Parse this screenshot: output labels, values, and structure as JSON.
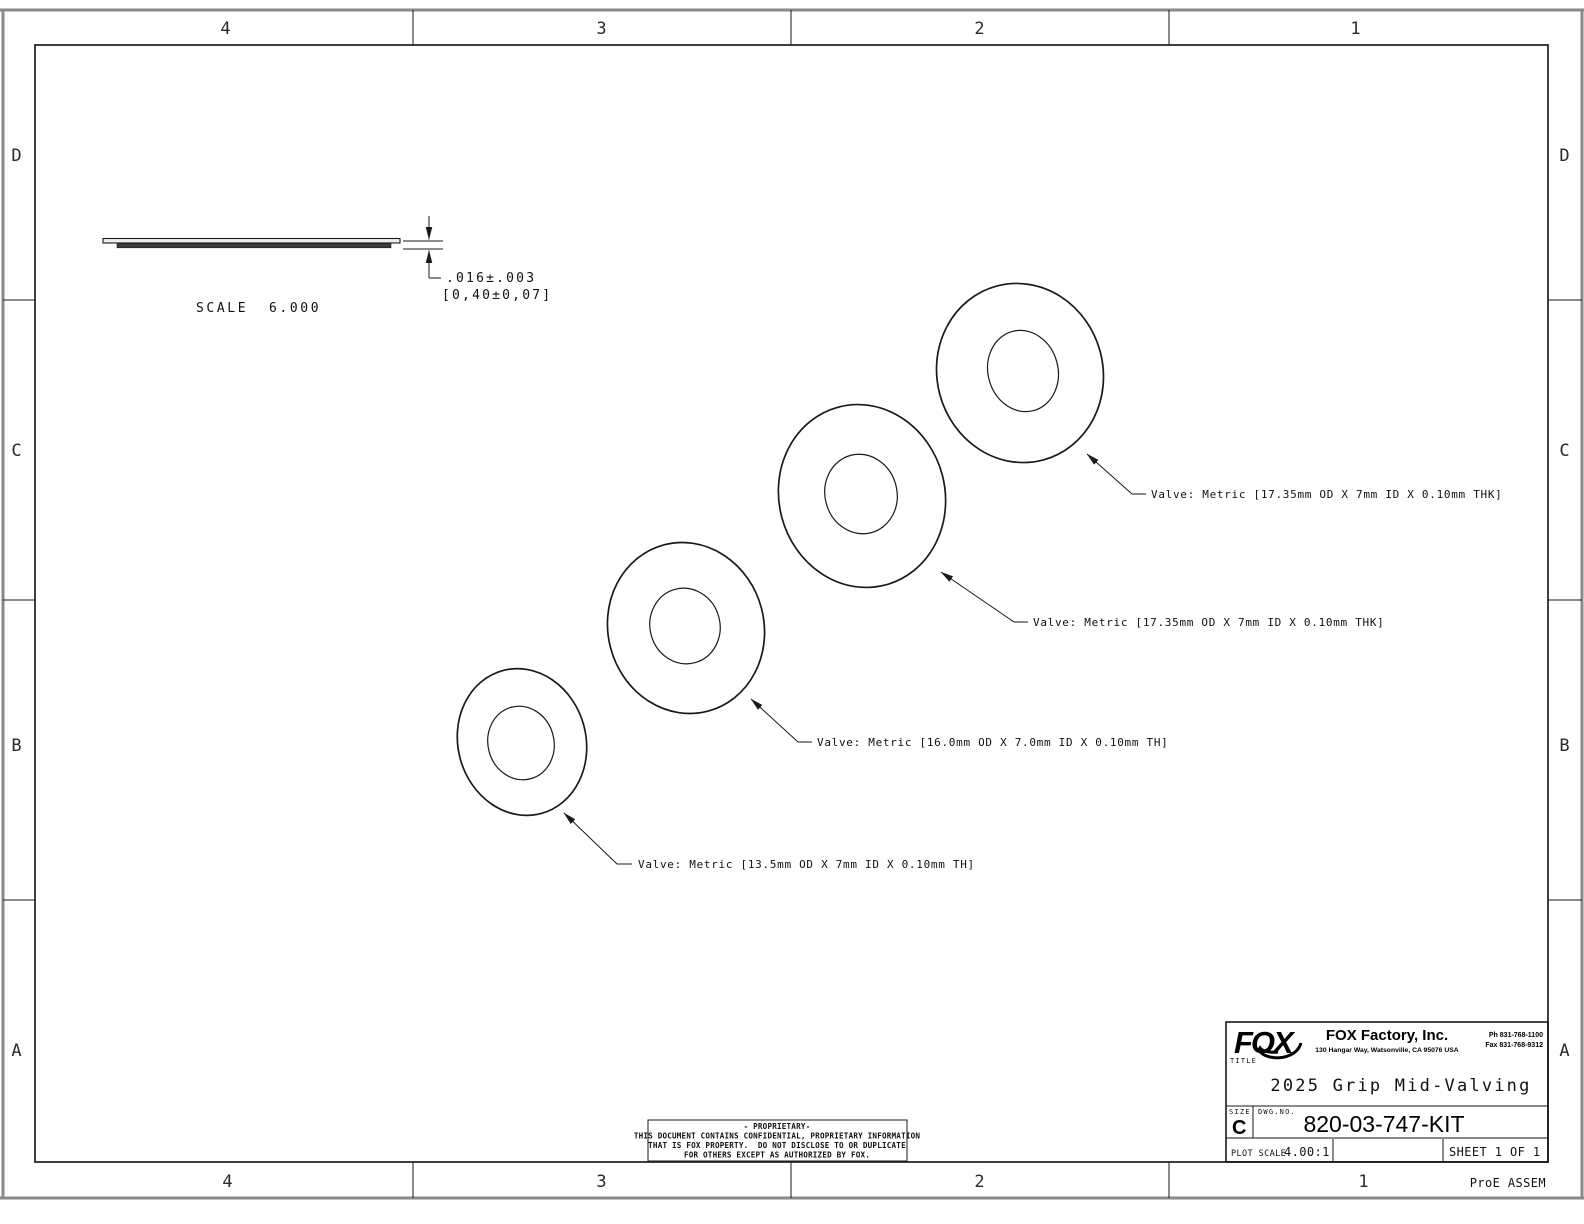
{
  "sheet": {
    "zones_top": [
      "4",
      "3",
      "2",
      "1"
    ],
    "zones_bottom": [
      "4",
      "3",
      "2",
      "1"
    ],
    "rows_left": [
      "D",
      "C",
      "B",
      "A"
    ],
    "rows_right": [
      "D",
      "C",
      "B",
      "A"
    ],
    "footer_note": "ProE ASSEM"
  },
  "side_view": {
    "dim_primary": ".016±.003",
    "dim_secondary": "[0,40±0,07]",
    "scale_label": "SCALE  6.000"
  },
  "valves": [
    {
      "label": "Valve: Metric [13.5mm OD X 7mm ID X 0.10mm TH]"
    },
    {
      "label": "Valve: Metric [16.0mm OD X 7.0mm ID X 0.10mm TH]"
    },
    {
      "label": "Valve: Metric [17.35mm OD X 7mm ID X 0.10mm THK]"
    },
    {
      "label": "Valve: Metric [17.35mm OD X 7mm ID X 0.10mm THK]"
    }
  ],
  "proprietary": {
    "line1": "- PROPRIETARY-",
    "line2": "THIS DOCUMENT CONTAINS CONFIDENTIAL, PROPRIETARY INFORMATION",
    "line3": "THAT IS FOX PROPERTY.  DO NOT DISCLOSE TO OR DUPLICATE",
    "line4": "FOR OTHERS EXCEPT AS AUTHORIZED BY FOX."
  },
  "title_block": {
    "logo_text": "FOX",
    "company": "FOX Factory, Inc.",
    "address": "130 Hangar Way, Watsonville, CA 95076 USA",
    "phone": "Ph 831-768-1100",
    "fax": "Fax 831-768-9312",
    "title_label": "TITLE",
    "title": "2025 Grip Mid-Valving",
    "size_label": "SIZE",
    "size": "C",
    "dwg_label": "DWG.NO.",
    "dwg_no": "820-03-747-KIT",
    "plot_scale_label": "PLOT SCALE",
    "plot_scale": "4.00:1",
    "sheet_of": "SHEET 1 OF 1"
  },
  "colors": {
    "line": "#1a1a1a",
    "frame_gray": "#8a8a8a",
    "background": "#ffffff",
    "plate_dark": "#3a3a3a"
  }
}
